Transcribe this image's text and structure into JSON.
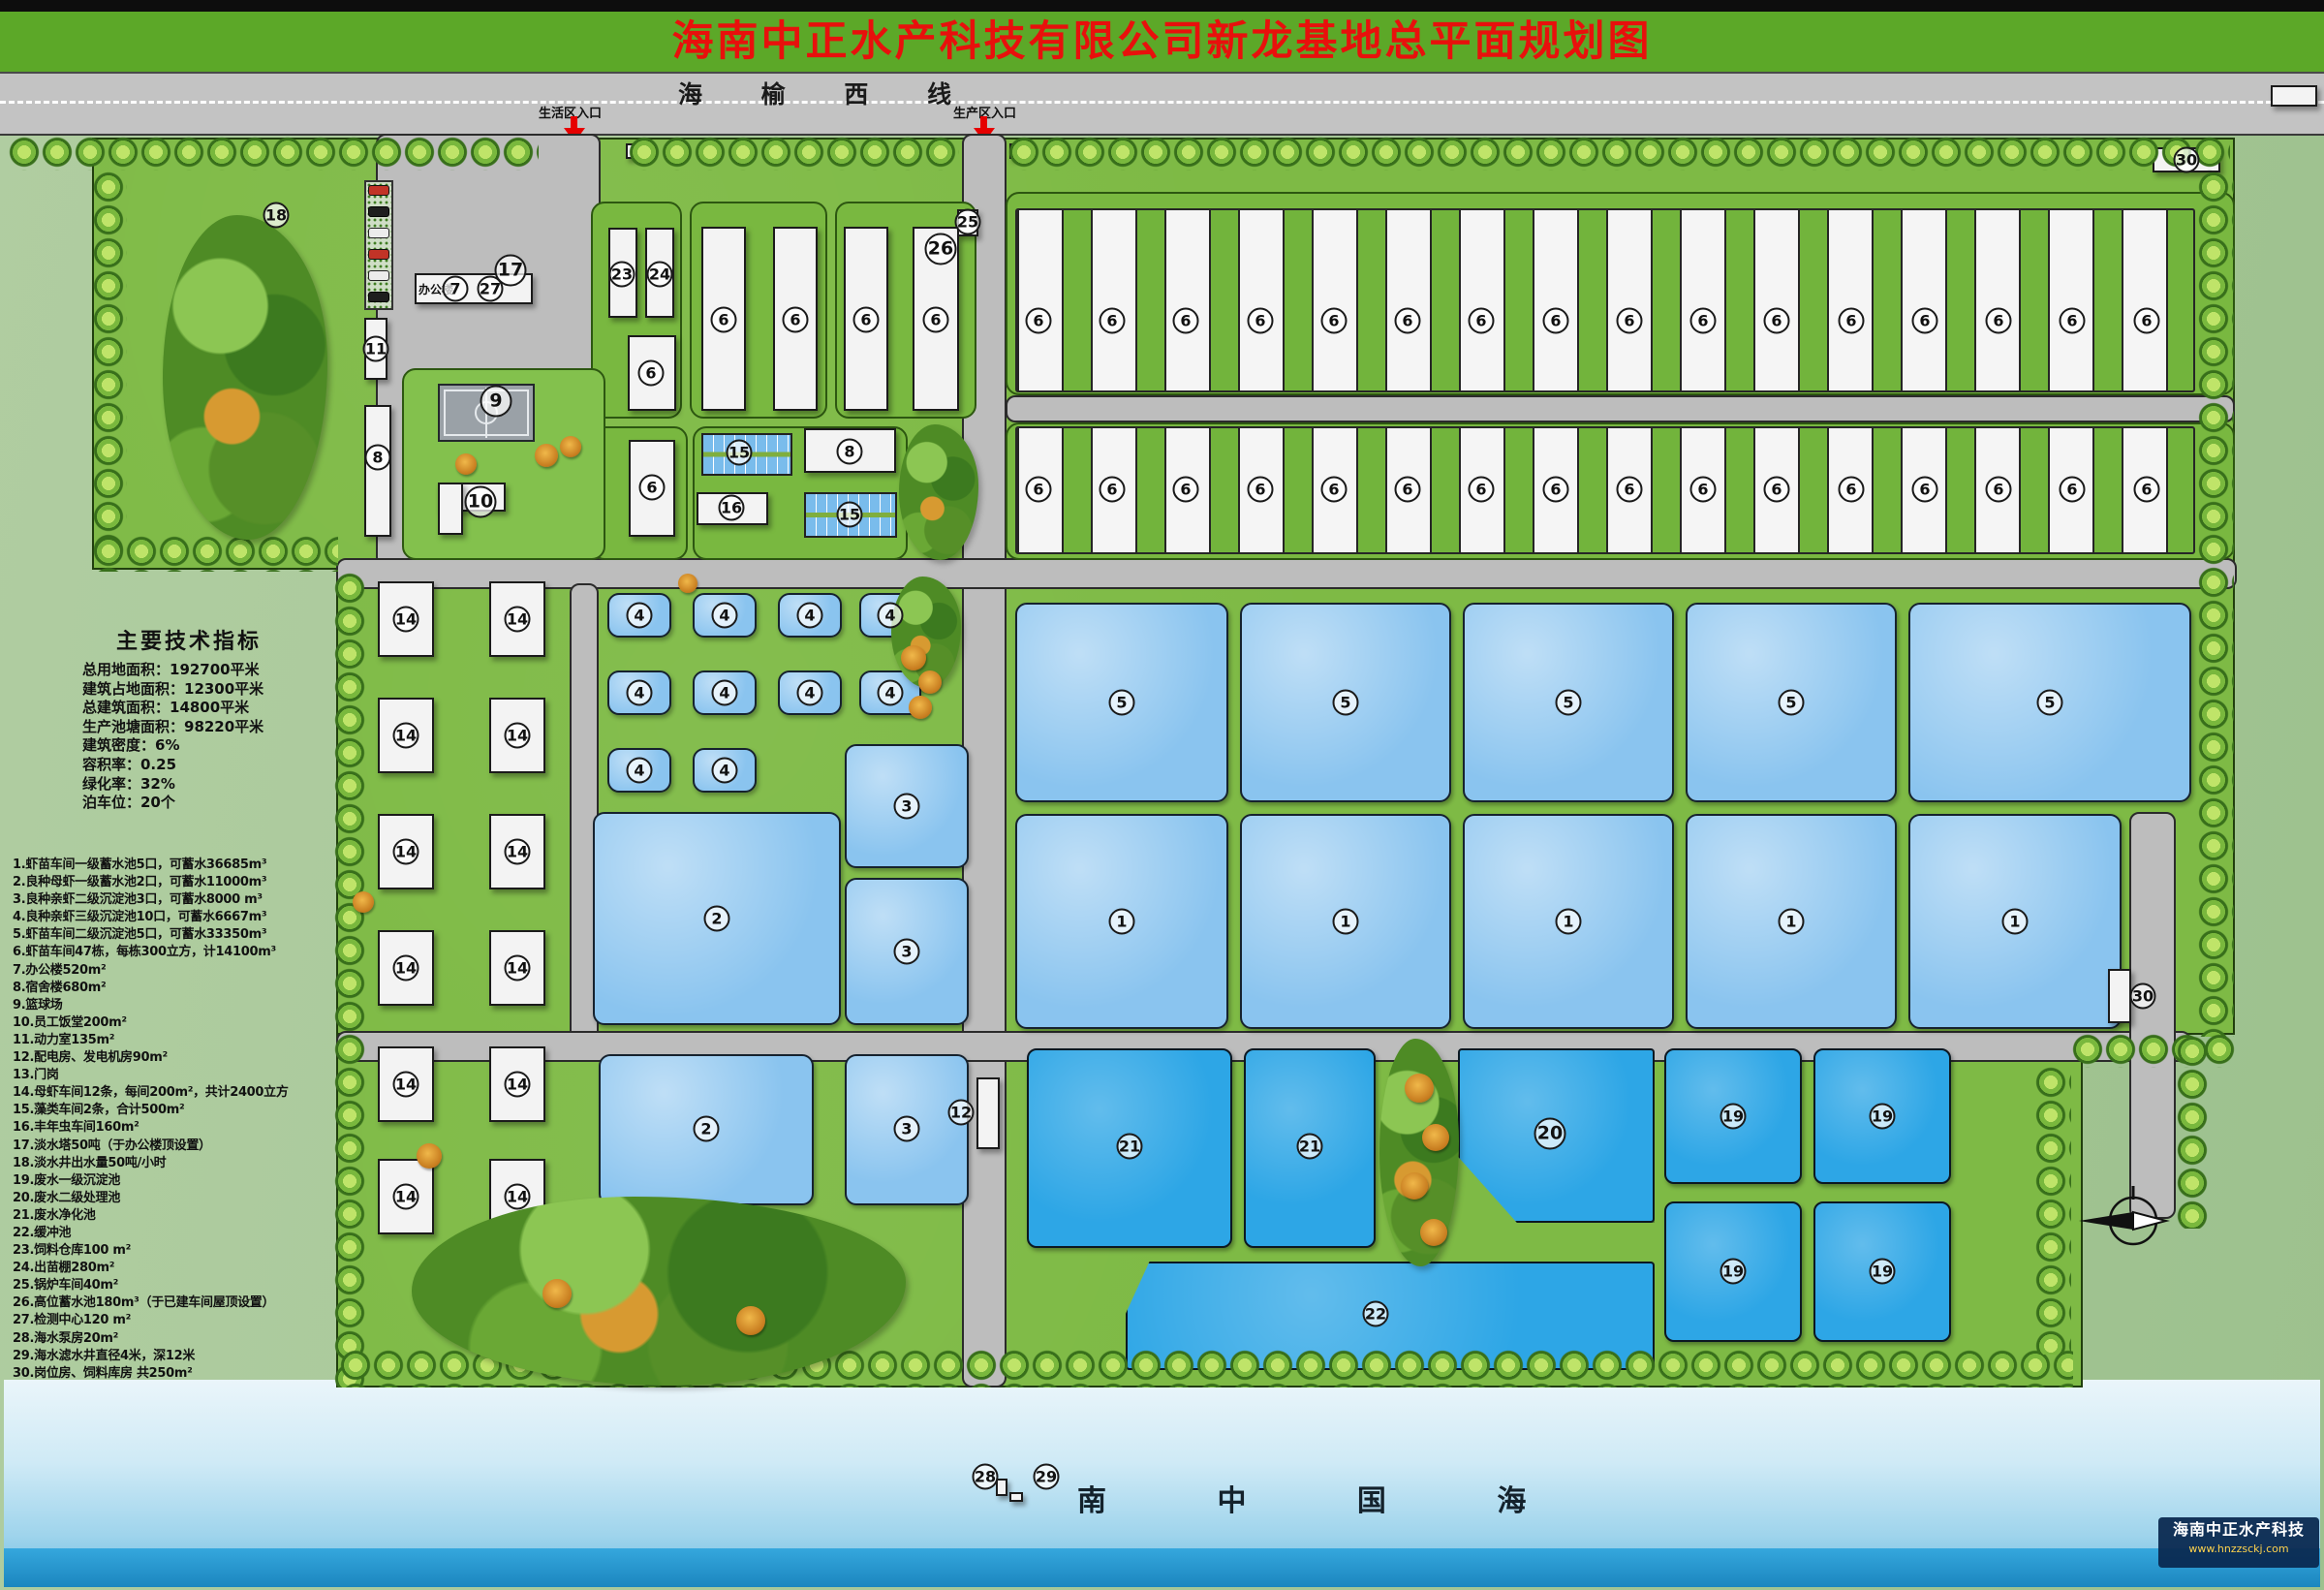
{
  "header": {
    "title": "海南中正水产科技有限公司新龙基地总平面规划图"
  },
  "road": {
    "name": "海 榆 西 线",
    "entrance_living": "生活区入口",
    "entrance_production": "生产区入口"
  },
  "tech": {
    "title": "主要技术指标",
    "lines": [
      "总用地面积：192700平米",
      "建筑占地面积：12300平米",
      "总建筑面积：14800平米",
      "生产池塘面积：98220平米",
      "建筑密度：6%",
      "容积率：0.25",
      "绿化率：32%",
      "泊车位：20个"
    ]
  },
  "legend": {
    "items": [
      "1.虾苗车间一级蓄水池5口，可蓄水36685m³",
      "2.良种母虾一级蓄水池2口，可蓄水11000m³",
      "3.良种亲虾二级沉淀池3口，可蓄水8000 m³",
      "4.良种亲虾三级沉淀池10口，可蓄水6667m³",
      "5.虾苗车间二级沉淀池5口，可蓄水33350m³",
      "6.虾苗车间47栋，每栋300立方，计14100m³",
      "7.办公楼520m²",
      "8.宿舍楼680m²",
      "9.篮球场",
      "10.员工饭堂200m²",
      "11.动力室135m²",
      "12.配电房、发电机房90m²",
      "13.门岗",
      "14.母虾车间12条，每间200m²，共计2400立方",
      "15.藻类车间2条，合计500m²",
      "16.丰年虫车间160m²",
      "17.淡水塔50吨（于办公楼顶设置）",
      "18.淡水井出水量50吨/小时",
      "19.废水一级沉淀池",
      "20.废水二级处理池",
      "21.废水净化池",
      "22.缓冲池",
      "23.饲料仓库100 m²",
      "24.出苗棚280m²",
      "25.锅炉车间40m²",
      "26.高位蓄水池180m³（于已建车间屋顶设置）",
      "27.检测中心120 m²",
      "28.海水泵房20m²",
      "29.海水滤水井直径4米，深12米",
      "30.岗位房、饲料库房 共250m²"
    ]
  },
  "office": {
    "caption": "办公楼"
  },
  "sea": {
    "name": "南 中 国 海"
  },
  "logo": {
    "company": "海南中正水产科技",
    "url": "www.hnzzsckj.com"
  },
  "colors": {
    "header_green": "#5ca828",
    "title_red": "#e8100c",
    "grass": "#7eba45",
    "road_gray": "#bdbdbd",
    "pond_light": "#8ac4ef",
    "pond_deep": "#2da6e6",
    "sea_bar": "#1b86bf"
  },
  "map": {
    "shapes": [
      [
        "grass",
        95,
        142,
        2212,
        446
      ],
      [
        "grass",
        347,
        588,
        1960,
        480
      ],
      [
        "grass",
        347,
        1068,
        1803,
        364
      ],
      [
        "road",
        388,
        138,
        232,
        447
      ],
      [
        "road",
        993,
        138,
        46,
        1294
      ],
      [
        "road",
        347,
        576,
        1962,
        32
      ],
      [
        "road",
        588,
        602,
        30,
        494
      ],
      [
        "road",
        347,
        1064,
        1915,
        32
      ],
      [
        "road",
        2198,
        838,
        48,
        420
      ],
      [
        "gblock",
        610,
        208,
        94,
        224
      ],
      [
        "gblock",
        712,
        208,
        142,
        224
      ],
      [
        "gblock",
        862,
        208,
        146,
        224
      ],
      [
        "gblock",
        610,
        440,
        100,
        138
      ],
      [
        "gblock",
        715,
        440,
        222,
        138
      ],
      [
        "gblock",
        1038,
        198,
        1269,
        210
      ],
      [
        "gblock",
        1038,
        436,
        1269,
        142
      ],
      [
        "road",
        1038,
        408,
        1269,
        28
      ],
      [
        "gisland",
        415,
        380,
        210,
        198
      ],
      [
        "stripband",
        1048,
        215,
        1218,
        190
      ],
      [
        "stripband",
        1048,
        440,
        1218,
        132
      ],
      [
        "pond",
        627,
        612,
        66,
        46
      ],
      [
        "pond",
        715,
        612,
        66,
        46
      ],
      [
        "pond",
        803,
        612,
        66,
        46
      ],
      [
        "pond",
        887,
        612,
        64,
        46
      ],
      [
        "pond",
        627,
        692,
        66,
        46
      ],
      [
        "pond",
        715,
        692,
        66,
        46
      ],
      [
        "pond",
        803,
        692,
        66,
        46
      ],
      [
        "pond",
        887,
        692,
        64,
        46
      ],
      [
        "pond",
        627,
        772,
        66,
        46
      ],
      [
        "pond",
        715,
        772,
        66,
        46
      ],
      [
        "pond",
        612,
        838,
        256,
        220
      ],
      [
        "pond",
        872,
        768,
        128,
        128
      ],
      [
        "pond",
        872,
        906,
        128,
        152
      ],
      [
        "pond",
        618,
        1088,
        222,
        156
      ],
      [
        "pond",
        872,
        1088,
        128,
        156
      ],
      [
        "pond",
        1048,
        622,
        220,
        206
      ],
      [
        "pond",
        1280,
        622,
        218,
        206
      ],
      [
        "pond",
        1510,
        622,
        218,
        206
      ],
      [
        "pond",
        1740,
        622,
        218,
        206
      ],
      [
        "pond",
        1970,
        622,
        292,
        206
      ],
      [
        "pond",
        1048,
        840,
        220,
        222
      ],
      [
        "pond",
        1280,
        840,
        218,
        222
      ],
      [
        "pond",
        1510,
        840,
        218,
        222
      ],
      [
        "pond",
        1740,
        840,
        218,
        222
      ],
      [
        "pond",
        1970,
        840,
        220,
        222
      ],
      [
        "pond-d",
        1060,
        1082,
        212,
        206
      ],
      [
        "pond-d",
        1284,
        1082,
        136,
        206
      ],
      [
        "pond-d",
        1505,
        1082,
        203,
        180,
        "clip-path:polygon(0 0,100% 0,100% 100%,30% 100%,0 62%);border-radius:4px;"
      ],
      [
        "pond-d",
        1718,
        1082,
        142,
        140
      ],
      [
        "pond-d",
        1872,
        1082,
        142,
        140
      ],
      [
        "pond-d",
        1718,
        1240,
        142,
        145
      ],
      [
        "pond-d",
        1872,
        1240,
        142,
        145
      ],
      [
        "pond-d",
        1162,
        1302,
        546,
        112,
        "clip-path:polygon(4.5% 0,100% 0,100% 100%,0 100%,0 48%);border-radius:4px;"
      ],
      [
        "grid15",
        724,
        447,
        94,
        44
      ],
      [
        "grid15",
        830,
        508,
        96,
        47
      ],
      [
        "court",
        452,
        396,
        100,
        60
      ],
      [
        "wline",
        501,
        400,
        2,
        52
      ],
      [
        "bldg",
        376,
        328,
        24,
        64
      ],
      [
        "bldg",
        376,
        418,
        28,
        136
      ],
      [
        "bldg",
        428,
        282,
        122,
        32
      ],
      [
        "bldg",
        452,
        498,
        70,
        30
      ],
      [
        "bldg",
        452,
        498,
        26,
        54
      ],
      [
        "bldg",
        628,
        235,
        30,
        93
      ],
      [
        "bldg",
        666,
        235,
        30,
        93
      ],
      [
        "bldg",
        648,
        346,
        50,
        78
      ],
      [
        "bldg",
        724,
        234,
        46,
        190
      ],
      [
        "bldg",
        798,
        234,
        46,
        190
      ],
      [
        "bldg",
        871,
        234,
        46,
        190
      ],
      [
        "bldg",
        942,
        234,
        48,
        190
      ],
      [
        "bldg",
        988,
        216,
        22,
        28
      ],
      [
        "bldg",
        649,
        454,
        48,
        100
      ],
      [
        "bldg",
        830,
        442,
        95,
        46
      ],
      [
        "bldg",
        719,
        508,
        74,
        34
      ],
      [
        "bldg",
        1008,
        1112,
        24,
        74
      ],
      [
        "bldg",
        2222,
        152,
        70,
        26
      ],
      [
        "bldg",
        2176,
        1000,
        24,
        56
      ],
      [
        "bldg",
        390,
        600,
        58,
        78
      ],
      [
        "bldg",
        505,
        600,
        58,
        78
      ],
      [
        "bldg",
        390,
        720,
        58,
        78
      ],
      [
        "bldg",
        505,
        720,
        58,
        78
      ],
      [
        "bldg",
        390,
        840,
        58,
        78
      ],
      [
        "bldg",
        505,
        840,
        58,
        78
      ],
      [
        "bldg",
        390,
        960,
        58,
        78
      ],
      [
        "bldg",
        505,
        960,
        58,
        78
      ],
      [
        "bldg",
        390,
        1080,
        58,
        78
      ],
      [
        "bldg",
        505,
        1080,
        58,
        78
      ],
      [
        "bldg",
        390,
        1196,
        58,
        78
      ],
      [
        "bldg",
        505,
        1196,
        58,
        78
      ],
      [
        "bldg",
        646,
        148,
        16,
        16
      ],
      [
        "bldg",
        1042,
        148,
        16,
        16
      ],
      [
        "bldg",
        1028,
        1526,
        12,
        18
      ],
      [
        "bldg",
        1042,
        1540,
        14,
        10
      ],
      [
        "bldg",
        2344,
        88,
        48,
        22
      ],
      [
        "park",
        376,
        186,
        30,
        134
      ],
      [
        "car-r",
        380,
        191,
        22,
        11
      ],
      [
        "car-k",
        380,
        213,
        22,
        11
      ],
      [
        "car-w",
        380,
        235,
        22,
        11
      ],
      [
        "car-r",
        380,
        257,
        22,
        11
      ],
      [
        "car-w",
        380,
        279,
        22,
        11
      ],
      [
        "car-k",
        380,
        301,
        22,
        11
      ],
      [
        "trow",
        8,
        140,
        548,
        36
      ],
      [
        "trow",
        648,
        140,
        342,
        36
      ],
      [
        "trow",
        1040,
        140,
        1262,
        36
      ],
      [
        "tcol",
        95,
        176,
        36,
        414
      ],
      [
        "trow",
        95,
        552,
        254,
        38
      ],
      [
        "tcol",
        344,
        590,
        34,
        842
      ],
      [
        "trow",
        350,
        1392,
        1790,
        40
      ],
      [
        "tcol",
        2268,
        176,
        38,
        894
      ],
      [
        "tcol",
        2100,
        1100,
        38,
        298
      ],
      [
        "trow",
        2138,
        1066,
        170,
        36
      ],
      [
        "tcol",
        2246,
        1068,
        34,
        200
      ],
      [
        "blob",
        168,
        222,
        170,
        335
      ],
      [
        "blob",
        425,
        1235,
        510,
        195
      ],
      [
        "blob",
        920,
        595,
        72,
        115
      ],
      [
        "blob",
        1424,
        1072,
        82,
        235
      ],
      [
        "blob",
        928,
        438,
        82,
        140
      ],
      [
        "otree",
        552,
        458,
        24,
        24
      ],
      [
        "otree",
        578,
        450,
        22,
        22
      ],
      [
        "otree",
        470,
        468,
        22,
        22
      ],
      [
        "otree",
        930,
        666,
        26,
        26
      ],
      [
        "otree",
        948,
        692,
        24,
        24
      ],
      [
        "otree",
        938,
        718,
        24,
        24
      ],
      [
        "otree",
        700,
        592,
        20,
        20
      ],
      [
        "otree",
        1450,
        1108,
        30,
        30
      ],
      [
        "otree",
        1468,
        1160,
        28,
        28
      ],
      [
        "otree",
        1446,
        1210,
        28,
        28
      ],
      [
        "otree",
        1466,
        1258,
        28,
        28
      ],
      [
        "otree",
        560,
        1320,
        30,
        30
      ],
      [
        "otree",
        760,
        1348,
        30,
        30
      ],
      [
        "otree",
        430,
        1180,
        26,
        26
      ],
      [
        "otree",
        364,
        920,
        22,
        22
      ]
    ],
    "circles": [
      [
        "18",
        285,
        222
      ],
      [
        "17",
        527,
        279,
        1
      ],
      [
        "7",
        470,
        298
      ],
      [
        "27",
        506,
        298
      ],
      [
        "11",
        388,
        360
      ],
      [
        "8",
        390,
        472
      ],
      [
        "9",
        512,
        414,
        1
      ],
      [
        "10",
        496,
        518,
        1
      ],
      [
        "23",
        642,
        283
      ],
      [
        "24",
        681,
        283
      ],
      [
        "6",
        672,
        385
      ],
      [
        "6",
        747,
        330
      ],
      [
        "6",
        821,
        330
      ],
      [
        "6",
        894,
        330
      ],
      [
        "6",
        966,
        330
      ],
      [
        "26",
        971,
        257,
        1
      ],
      [
        "25",
        999,
        229
      ],
      [
        "6",
        673,
        503
      ],
      [
        "15",
        763,
        467
      ],
      [
        "8",
        877,
        466
      ],
      [
        "16",
        755,
        524
      ],
      [
        "15",
        877,
        531
      ],
      [
        "30",
        2257,
        165
      ],
      [
        "30",
        2212,
        1028
      ],
      [
        "12",
        992,
        1148
      ],
      [
        "6",
        1072,
        331
      ],
      [
        "6",
        1148,
        331
      ],
      [
        "6",
        1224,
        331
      ],
      [
        "6",
        1301,
        331
      ],
      [
        "6",
        1377,
        331
      ],
      [
        "6",
        1453,
        331
      ],
      [
        "6",
        1529,
        331
      ],
      [
        "6",
        1606,
        331
      ],
      [
        "6",
        1682,
        331
      ],
      [
        "6",
        1758,
        331
      ],
      [
        "6",
        1834,
        331
      ],
      [
        "6",
        1911,
        331
      ],
      [
        "6",
        1987,
        331
      ],
      [
        "6",
        2063,
        331
      ],
      [
        "6",
        2139,
        331
      ],
      [
        "6",
        2216,
        331
      ],
      [
        "6",
        1072,
        505
      ],
      [
        "6",
        1148,
        505
      ],
      [
        "6",
        1224,
        505
      ],
      [
        "6",
        1301,
        505
      ],
      [
        "6",
        1377,
        505
      ],
      [
        "6",
        1453,
        505
      ],
      [
        "6",
        1529,
        505
      ],
      [
        "6",
        1606,
        505
      ],
      [
        "6",
        1682,
        505
      ],
      [
        "6",
        1758,
        505
      ],
      [
        "6",
        1834,
        505
      ],
      [
        "6",
        1911,
        505
      ],
      [
        "6",
        1987,
        505
      ],
      [
        "6",
        2063,
        505
      ],
      [
        "6",
        2139,
        505
      ],
      [
        "6",
        2216,
        505
      ],
      [
        "4",
        660,
        635
      ],
      [
        "4",
        748,
        635
      ],
      [
        "4",
        836,
        635
      ],
      [
        "4",
        919,
        635
      ],
      [
        "4",
        660,
        715
      ],
      [
        "4",
        748,
        715
      ],
      [
        "4",
        836,
        715
      ],
      [
        "4",
        919,
        715
      ],
      [
        "4",
        660,
        795
      ],
      [
        "4",
        748,
        795
      ],
      [
        "2",
        740,
        948
      ],
      [
        "2",
        729,
        1165
      ],
      [
        "3",
        936,
        832
      ],
      [
        "3",
        936,
        982
      ],
      [
        "3",
        936,
        1165
      ],
      [
        "5",
        1158,
        725
      ],
      [
        "5",
        1389,
        725
      ],
      [
        "5",
        1619,
        725
      ],
      [
        "5",
        1849,
        725
      ],
      [
        "5",
        2116,
        725
      ],
      [
        "1",
        1158,
        951
      ],
      [
        "1",
        1389,
        951
      ],
      [
        "1",
        1619,
        951
      ],
      [
        "1",
        1849,
        951
      ],
      [
        "1",
        2080,
        951
      ],
      [
        "14",
        419,
        639
      ],
      [
        "14",
        534,
        639
      ],
      [
        "14",
        419,
        759
      ],
      [
        "14",
        534,
        759
      ],
      [
        "14",
        419,
        879
      ],
      [
        "14",
        534,
        879
      ],
      [
        "14",
        419,
        999
      ],
      [
        "14",
        534,
        999
      ],
      [
        "14",
        419,
        1119
      ],
      [
        "14",
        534,
        1119
      ],
      [
        "14",
        419,
        1235
      ],
      [
        "14",
        534,
        1235
      ],
      [
        "21",
        1166,
        1183
      ],
      [
        "21",
        1352,
        1183
      ],
      [
        "20",
        1600,
        1170,
        1
      ],
      [
        "19",
        1789,
        1152
      ],
      [
        "19",
        1943,
        1152
      ],
      [
        "19",
        1789,
        1312
      ],
      [
        "19",
        1943,
        1312
      ],
      [
        "22",
        1420,
        1356
      ],
      [
        "28",
        1017,
        1524
      ],
      [
        "29",
        1080,
        1524
      ]
    ]
  }
}
